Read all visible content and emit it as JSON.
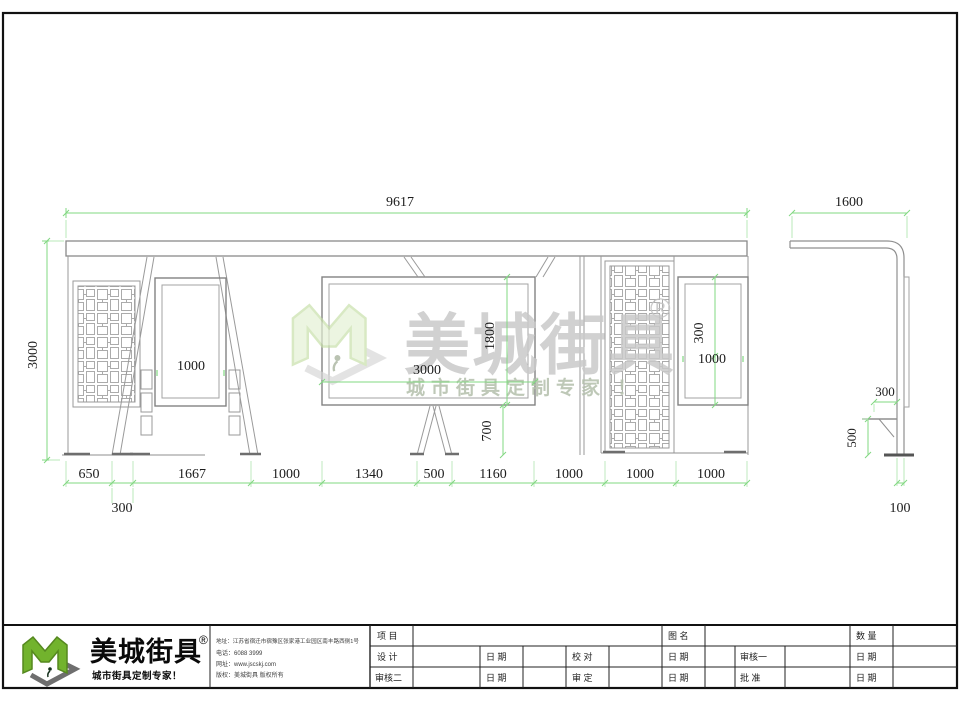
{
  "watermark": {
    "brand": "美城街具",
    "registered": "®",
    "tagline": "城市街具定制专家 ！"
  },
  "front_view": {
    "dim_total_width": "9617",
    "dim_height": "3000",
    "dim_left_sign_width": "1000",
    "dim_board_width": "3000",
    "dim_board_height": "1800",
    "dim_board_ground_gap": "700",
    "dim_right_sign_height": "300",
    "dim_right_sign_width": "1000",
    "dim_bottom": [
      "650",
      "1667",
      "1000",
      "1340",
      "500",
      "1160",
      "1000",
      "1000",
      "1000"
    ],
    "dim_bottom_offset": "300"
  },
  "side_view": {
    "dim_width": "1600",
    "dim_seat_depth": "300",
    "dim_seat_height": "500",
    "dim_post_width": "100"
  },
  "title_block": {
    "brand": "美城街具",
    "registered": "®",
    "tagline": "城市街具定制专家！",
    "contact_address": "地址：江苏省宿迁市宿豫区张家港工业园区南丰路西侧1号",
    "contact_phone": "电话：6088 3999",
    "contact_web": "网址：www.jscskj.com",
    "contact_copyright": "版权：美城街具 版权所有",
    "labels": {
      "project": "项 目",
      "drawing_name": "图 名",
      "quantity": "数 量",
      "design": "设 计",
      "date": "日 期",
      "proofread": "校 对",
      "reviewer1": "审核一",
      "reviewer2": "审核二",
      "approve": "审 定",
      "ratify": "批 准"
    }
  }
}
